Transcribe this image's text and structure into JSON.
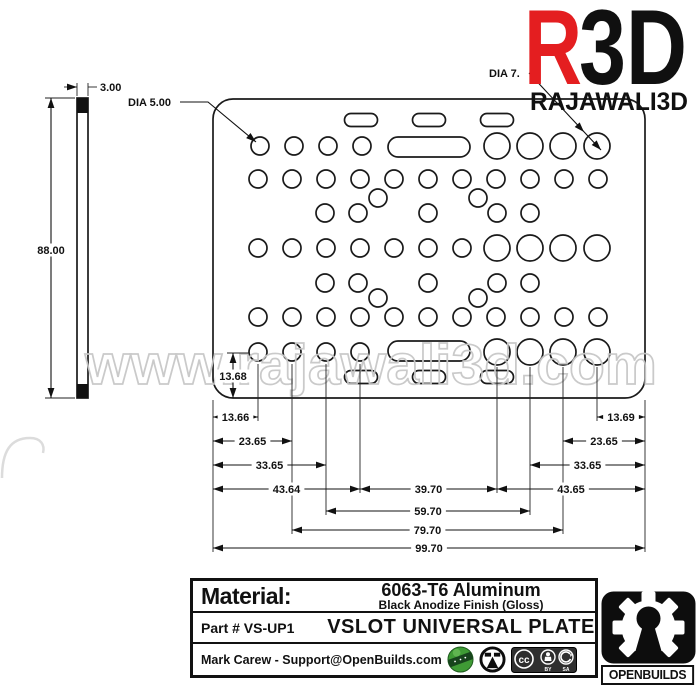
{
  "branding": {
    "logo_r": "R",
    "logo_3d": "3D",
    "logo_subtitle": "RAJAWALI3D",
    "logo_red": "#e41e20",
    "watermark": "www.rajawali3d.com"
  },
  "drawing": {
    "labels": {
      "dia_small": "DIA 5.00",
      "dia_large": "DIA 7.",
      "thickness": "3.00"
    },
    "plate": {
      "x": 213,
      "y": 99,
      "w": 432,
      "h": 299,
      "rx": 20
    },
    "side_view": {
      "x": 77,
      "y": 98,
      "w": 11,
      "h": 300,
      "band_h": 15
    },
    "holes_small_r": 9,
    "holes_large_r": 13,
    "holes_small": [
      {
        "y": 146,
        "x": [
          260,
          294,
          328,
          362
        ]
      },
      {
        "y": 179,
        "x": [
          258,
          292,
          326,
          360,
          394,
          428,
          462,
          496,
          530,
          564,
          598
        ]
      },
      {
        "y": 198,
        "x": [
          378,
          478
        ]
      },
      {
        "y": 213,
        "x": [
          325,
          358,
          428,
          497,
          530
        ]
      },
      {
        "y": 248,
        "x": [
          258,
          292,
          326,
          360,
          394,
          428,
          462
        ]
      },
      {
        "y": 283,
        "x": [
          325,
          358,
          428,
          497,
          530
        ]
      },
      {
        "y": 298,
        "x": [
          378,
          478
        ]
      },
      {
        "y": 317,
        "x": [
          258,
          292,
          326,
          360,
          394,
          428,
          462,
          496,
          530,
          564,
          598
        ]
      },
      {
        "y": 352,
        "x": [
          258,
          292,
          326,
          360
        ]
      }
    ],
    "holes_large": [
      {
        "y": 146,
        "x": [
          497,
          530,
          563,
          597
        ]
      },
      {
        "y": 248,
        "x": [
          497,
          530,
          563,
          597
        ]
      },
      {
        "y": 352,
        "x": [
          497,
          530,
          563,
          597
        ]
      }
    ],
    "slots_small": {
      "w": 33,
      "h": 13,
      "centers": [
        [
          361,
          120
        ],
        [
          429,
          120
        ],
        [
          497,
          120
        ],
        [
          361,
          377
        ],
        [
          429,
          377
        ],
        [
          497,
          377
        ]
      ]
    },
    "slots_long": {
      "w": 82,
      "h": 20,
      "pos": [
        [
          388,
          137
        ],
        [
          388,
          341
        ]
      ]
    },
    "dims_bottom": [
      {
        "label": "13.66",
        "x1": 213,
        "x2": 258,
        "y": 417
      },
      {
        "label": "23.65",
        "x1": 213,
        "x2": 292,
        "y": 441
      },
      {
        "label": "33.65",
        "x1": 213,
        "x2": 326,
        "y": 465
      },
      {
        "label": "43.64",
        "x1": 213,
        "x2": 360,
        "y": 489
      },
      {
        "label": "39.70",
        "x1": 360,
        "x2": 497,
        "y": 489
      },
      {
        "label": "43.65",
        "x1": 497,
        "x2": 645,
        "y": 489
      },
      {
        "label": "33.65",
        "x1": 530,
        "x2": 645,
        "y": 465
      },
      {
        "label": "23.65",
        "x1": 563,
        "x2": 645,
        "y": 441
      },
      {
        "label": "13.69",
        "x1": 597,
        "x2": 645,
        "y": 417
      },
      {
        "label": "59.70",
        "x1": 326,
        "x2": 530,
        "y": 511
      },
      {
        "label": "79.70",
        "x1": 292,
        "x2": 563,
        "y": 530
      },
      {
        "label": "99.70",
        "x1": 213,
        "x2": 645,
        "y": 548
      }
    ],
    "dims_vertical": [
      {
        "label": "88.00",
        "x": 51,
        "y1": 98,
        "y2": 398,
        "ly": 250
      },
      {
        "label": "13.68",
        "x": 233,
        "y1": 353,
        "y2": 398,
        "ly": 376
      }
    ],
    "ext_lines_v": [
      [
        213,
        400,
        552
      ],
      [
        258,
        364,
        421
      ],
      [
        292,
        364,
        534
      ],
      [
        326,
        364,
        515
      ],
      [
        360,
        364,
        493
      ],
      [
        497,
        367,
        493
      ],
      [
        530,
        367,
        515
      ],
      [
        563,
        367,
        534
      ],
      [
        597,
        367,
        421
      ],
      [
        645,
        400,
        552
      ],
      [
        77,
        83,
        96
      ],
      [
        88,
        83,
        96
      ]
    ],
    "ext_lines_h": [
      [
        45,
        98,
        75
      ],
      [
        45,
        398,
        75
      ],
      [
        227,
        353,
        249
      ],
      [
        64,
        87,
        77
      ],
      [
        88,
        87,
        97
      ]
    ],
    "extra_arrows": [
      [
        77,
        87,
        0
      ]
    ],
    "leaders": [
      {
        "d": "M180 102 L208 102 L256 142",
        "arrows": [
          [
            256,
            142,
            40
          ]
        ]
      },
      {
        "d": "M529 73 L601 150",
        "arrows": [
          [
            584,
            132,
            47
          ],
          [
            601,
            150,
            47
          ]
        ]
      }
    ]
  },
  "title_block": {
    "material_label": "Material:",
    "material_value": "6063-T6 Aluminum",
    "material_finish": "Black Anodize Finish (Gloss)",
    "part_number": "Part # VS-UP1",
    "part_title": "VSLOT UNIVERSAL PLATE",
    "credit": "Mark Carew - Support@OpenBuilds.com",
    "cc_label": "cc",
    "cc_by": "BY",
    "cc_sa": "SA",
    "openbuilds_label": "OPENBUILDS"
  }
}
